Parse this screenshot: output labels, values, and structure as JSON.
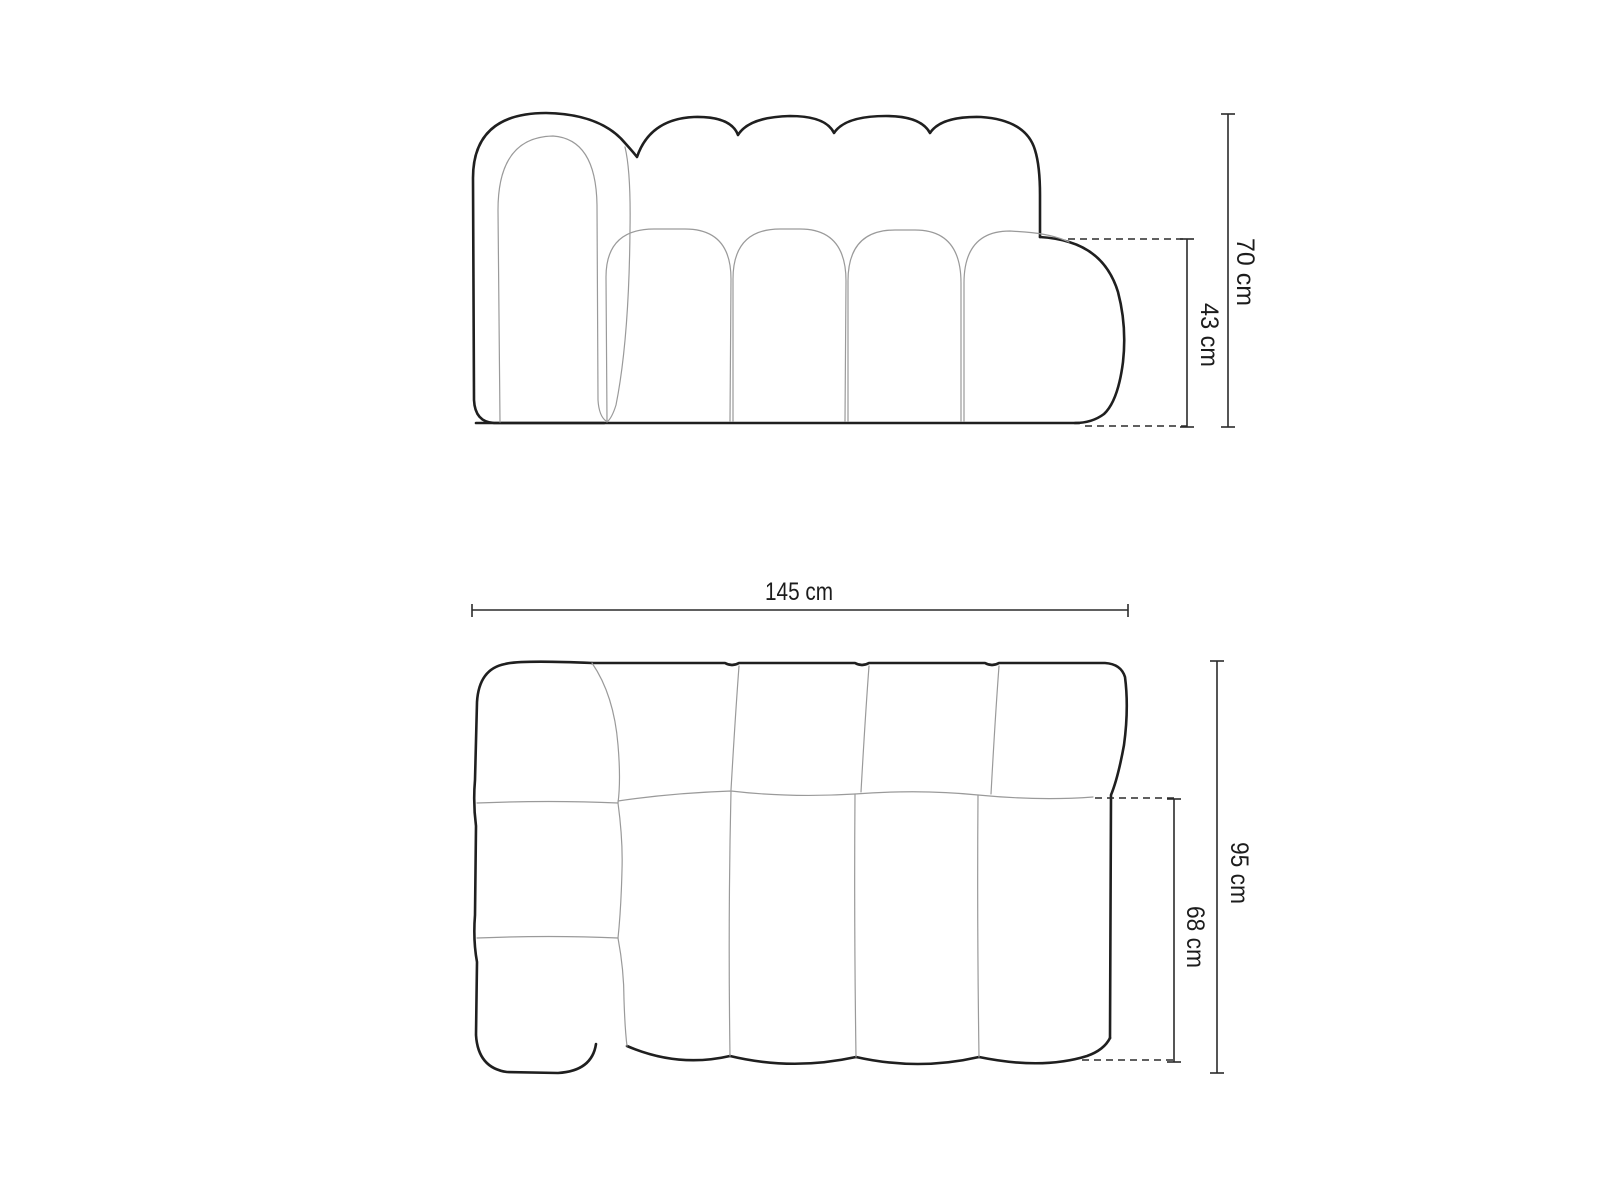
{
  "diagram": {
    "front_view": {
      "dimensions": {
        "total_height": "70 cm",
        "seat_height": "43 cm"
      }
    },
    "top_view": {
      "dimensions": {
        "total_width": "145 cm",
        "total_depth": "95 cm",
        "seat_depth": "68 cm"
      }
    },
    "colors": {
      "line_dark": "#1f1f1f",
      "line_light": "#9a9a9a",
      "dimension_line": "#2b2b2b",
      "label_text": "#1c1c1c",
      "background": "#ffffff"
    }
  }
}
